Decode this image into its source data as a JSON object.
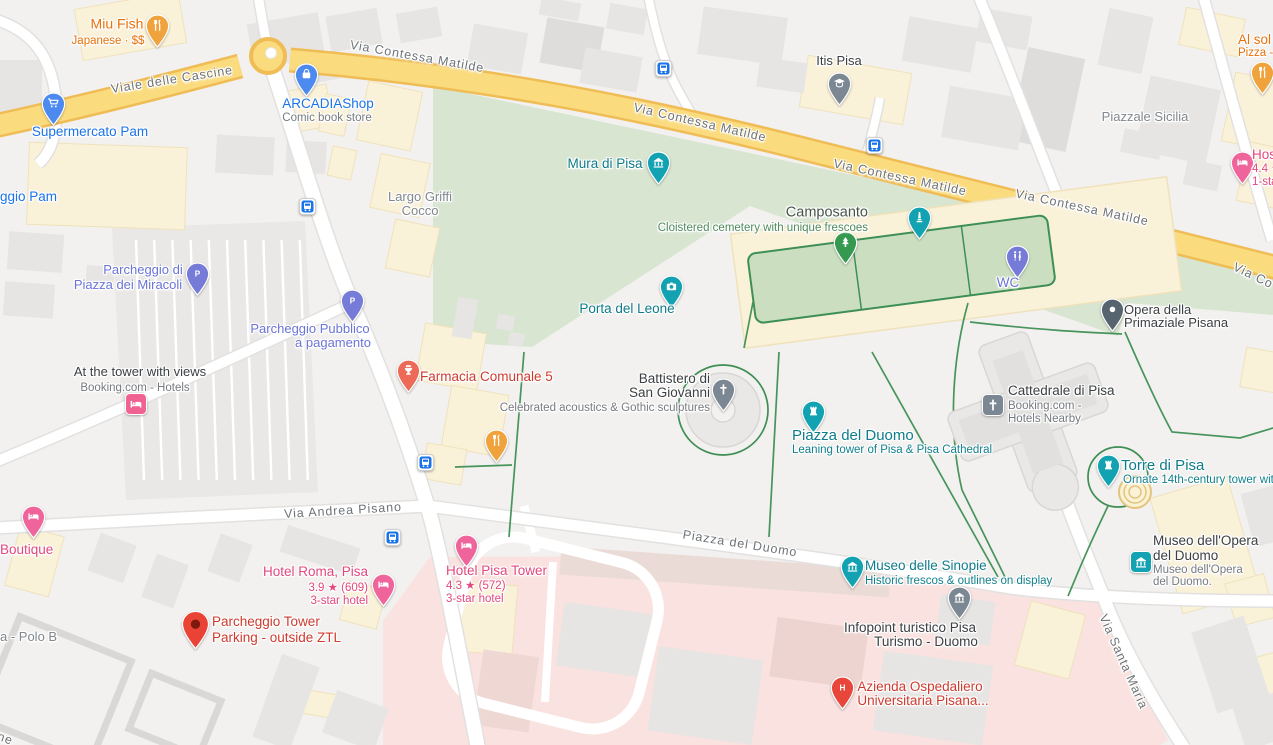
{
  "palette": {
    "land": "#F2F1EF",
    "building": "#E6E5E3",
    "building_dark": "#DEDDDB",
    "building_stroke": "#D9D8D6",
    "commercial": "#FAF1D9",
    "commercial_border": "#EFE2BB",
    "park": "#D8E5D1",
    "courtyard": "#CBDFC0",
    "courtyard_border": "#3D8F55",
    "hospital_area": "#F9E2DF",
    "road_white": "#FFFFFF",
    "road_casing": "#E2E1DF",
    "road_major_fill": "#FADB7E",
    "road_major_casing": "#EFBC55",
    "path_green": "#3E8E54",
    "bus_blue": "#1A73E8",
    "street_label": "#6E7377",
    "area_label": "#82878C"
  },
  "road_labels": [
    {
      "text": "Viale delle Cascine",
      "x": 172,
      "y": 80,
      "rot": -9
    },
    {
      "text": "Via Contessa Matilde",
      "x": 417,
      "y": 57,
      "rot": 10
    },
    {
      "text": "Via Contessa Matilde",
      "x": 700,
      "y": 123,
      "rot": 13
    },
    {
      "text": "Via Contessa Matilde",
      "x": 900,
      "y": 178,
      "rot": 12
    },
    {
      "text": "Via Contessa Matilde",
      "x": 1082,
      "y": 208,
      "rot": 12
    },
    {
      "text": "Via Co",
      "x": 1253,
      "y": 276,
      "rot": 26
    },
    {
      "text": "Via Andrea Pisano",
      "x": 343,
      "y": 511,
      "rot": -3.5
    },
    {
      "text": "Piazza del Duomo",
      "x": 740,
      "y": 544,
      "rot": 9
    },
    {
      "text": "Via Santa Maria",
      "x": 1123,
      "y": 662,
      "rot": 66
    },
    {
      "text": "ne",
      "x": 5,
      "y": 739,
      "rot": 20
    }
  ],
  "area_labels": [
    {
      "text": "Largo Griffi",
      "x": 420,
      "y": 197,
      "align": "center"
    },
    {
      "text": "Cocco",
      "x": 420,
      "y": 211,
      "align": "center"
    },
    {
      "text": "Piazzale Sicilia",
      "x": 1145,
      "y": 117,
      "align": "center"
    },
    {
      "text": "a - Polo B",
      "x": 0,
      "y": 637,
      "align": "left"
    }
  ],
  "bus_stops": [
    {
      "x": 663,
      "y": 68
    },
    {
      "x": 874,
      "y": 145
    },
    {
      "x": 307,
      "y": 206
    },
    {
      "x": 425,
      "y": 462
    },
    {
      "x": 392,
      "y": 537
    }
  ],
  "pois": [
    {
      "name": "miu-fish",
      "pin": {
        "x": 157,
        "y": 26,
        "shape": "pin",
        "color": "#F0A33C",
        "icon": "restaurant"
      },
      "lines": [
        {
          "text": "Miu Fish",
          "x": 117,
          "y": 24,
          "size": 14,
          "color": "#E8710A",
          "align": "center",
          "w": 500
        },
        {
          "text": "Japanese · $$",
          "x": 108,
          "y": 41,
          "size": 11.5,
          "color": "#E8710A",
          "align": "center",
          "w": 400
        }
      ]
    },
    {
      "name": "supermercato-pam",
      "pin": {
        "x": 53,
        "y": 104,
        "shape": "pin",
        "color": "#4D8AF0",
        "icon": "cart"
      },
      "lines": [
        {
          "text": "Supermercato Pam",
          "x": 90,
          "y": 132,
          "size": 13.5,
          "color": "#1A73E8",
          "align": "center",
          "w": 500
        }
      ]
    },
    {
      "name": "parcheggio-pam",
      "lines": [
        {
          "text": "ggio Pam",
          "x": 0,
          "y": 197,
          "size": 13.5,
          "color": "#1A73E8",
          "align": "left",
          "w": 500
        }
      ]
    },
    {
      "name": "arcadia-shop",
      "pin": {
        "x": 306,
        "y": 75,
        "shape": "pin",
        "color": "#4D8AF0",
        "icon": "bag"
      },
      "lines": [
        {
          "text": "ARCADIAShop",
          "x": 328,
          "y": 104,
          "size": 13.5,
          "color": "#1A73E8",
          "align": "center",
          "w": 500
        },
        {
          "text": "Comic book store",
          "x": 327,
          "y": 118,
          "size": 11.5,
          "color": "#767B80",
          "align": "center",
          "w": 400
        }
      ]
    },
    {
      "name": "itis-pisa",
      "pin": {
        "x": 839,
        "y": 84,
        "shape": "pin",
        "color": "#7B8893",
        "icon": "school"
      },
      "lines": [
        {
          "text": "Itis Pisa",
          "x": 839,
          "y": 61,
          "size": 13,
          "color": "#3C4043",
          "align": "center",
          "w": 500
        }
      ]
    },
    {
      "name": "mura-di-pisa",
      "pin": {
        "x": 658,
        "y": 163,
        "shape": "pin",
        "color": "#12A2B2",
        "icon": "museum"
      },
      "lines": [
        {
          "text": "Mura di Pisa",
          "x": 605,
          "y": 164,
          "size": 13.5,
          "color": "#0E7C8A",
          "align": "center",
          "w": 500
        }
      ]
    },
    {
      "name": "camposanto",
      "pin": {
        "x": 845,
        "y": 243,
        "shape": "pin",
        "color": "#359A4F",
        "icon": "tree"
      },
      "lines": [
        {
          "text": "Camposanto",
          "x": 868,
          "y": 213,
          "size": 14.5,
          "color": "#48534A",
          "align": "right",
          "w": 500
        },
        {
          "text": "Cloistered cemetery with unique frescoes",
          "x": 868,
          "y": 228,
          "size": 11.5,
          "color": "#4F8A5C",
          "align": "right",
          "w": 400
        }
      ]
    },
    {
      "name": "camposanto-monument",
      "pin": {
        "x": 919,
        "y": 218,
        "shape": "pin",
        "color": "#12A2B2",
        "icon": "monument"
      },
      "lines": []
    },
    {
      "name": "wc",
      "pin": {
        "x": 1017,
        "y": 257,
        "shape": "pin",
        "color": "#767BD8",
        "icon": "toilets"
      },
      "lines": [
        {
          "text": "WC",
          "x": 1008,
          "y": 283,
          "size": 13.5,
          "color": "#6B74D8",
          "align": "center",
          "w": 500
        }
      ]
    },
    {
      "name": "porta-del-leone",
      "pin": {
        "x": 671,
        "y": 287,
        "shape": "pin",
        "color": "#12A2B2",
        "icon": "camera"
      },
      "lines": [
        {
          "text": "Porta del Leone",
          "x": 627,
          "y": 309,
          "size": 13.5,
          "color": "#0E7C8A",
          "align": "center",
          "w": 500
        }
      ]
    },
    {
      "name": "opera-della-primaziale-pisana",
      "pin": {
        "x": 1112,
        "y": 310,
        "shape": "pin",
        "color": "#55646F",
        "icon": "dot"
      },
      "lines": [
        {
          "text": "Opera della",
          "x": 1124,
          "y": 310,
          "size": 13,
          "color": "#3C4043",
          "align": "left",
          "w": 500
        },
        {
          "text": "Primaziale Pisana",
          "x": 1124,
          "y": 323,
          "size": 13,
          "color": "#3C4043",
          "align": "left",
          "w": 500
        }
      ]
    },
    {
      "name": "parcheggio-piazza-dei-miracoli",
      "pin": {
        "x": 197,
        "y": 274,
        "shape": "pin",
        "color": "#767BD8",
        "icon": "P"
      },
      "lines": [
        {
          "text": "Parcheggio di",
          "x": 143,
          "y": 270,
          "size": 13,
          "color": "#6B74D8",
          "align": "center",
          "w": 500
        },
        {
          "text": "Piazza dei Miracoli",
          "x": 128,
          "y": 285,
          "size": 13,
          "color": "#6B74D8",
          "align": "center",
          "w": 500
        }
      ]
    },
    {
      "name": "parcheggio-pubblico",
      "pin": {
        "x": 352,
        "y": 301,
        "shape": "pin",
        "color": "#767BD8",
        "icon": "P"
      },
      "lines": [
        {
          "text": "Parcheggio Pubblico",
          "x": 310,
          "y": 329,
          "size": 13,
          "color": "#6B74D8",
          "align": "center",
          "w": 500
        },
        {
          "text": "a pagamento",
          "x": 333,
          "y": 343,
          "size": 13,
          "color": "#6B74D8",
          "align": "center",
          "w": 500
        }
      ]
    },
    {
      "name": "at-the-tower-with-views",
      "pin": {
        "x": 136,
        "y": 404,
        "shape": "chip",
        "color": "#F06292",
        "icon": "bed"
      },
      "lines": [
        {
          "text": "At the tower with views",
          "x": 140,
          "y": 372,
          "size": 13,
          "color": "#3C4043",
          "align": "center",
          "w": 500
        },
        {
          "text": "Booking.com - Hotels",
          "x": 135,
          "y": 388,
          "size": 11.5,
          "color": "#767B80",
          "align": "center",
          "w": 400
        }
      ]
    },
    {
      "name": "farmacia-comunale-5",
      "pin": {
        "x": 408,
        "y": 371,
        "shape": "pin",
        "color": "#EC6A57",
        "icon": "pharmacy"
      },
      "lines": [
        {
          "text": "Farmacia Comunale 5",
          "x": 420,
          "y": 377,
          "size": 13.5,
          "color": "#CE3A2E",
          "align": "left",
          "w": 500
        }
      ]
    },
    {
      "name": "battistero-di-san-giovanni",
      "pin": {
        "x": 723,
        "y": 390,
        "shape": "pin",
        "color": "#7B8893",
        "icon": "cross"
      },
      "lines": [
        {
          "text": "Battistero di",
          "x": 710,
          "y": 379,
          "size": 13.5,
          "color": "#3C4043",
          "align": "right",
          "w": 500
        },
        {
          "text": "San Giovanni",
          "x": 710,
          "y": 393,
          "size": 13.5,
          "color": "#3C4043",
          "align": "right",
          "w": 500
        },
        {
          "text": "Celebrated acoustics & Gothic sculptures",
          "x": 710,
          "y": 408,
          "size": 11.5,
          "color": "#767B80",
          "align": "right",
          "w": 400
        }
      ]
    },
    {
      "name": "piazza-del-duomo",
      "pin": {
        "x": 813,
        "y": 412,
        "shape": "pin",
        "color": "#12A2B2",
        "icon": "fort"
      },
      "lines": [
        {
          "text": "Piazza del Duomo",
          "x": 792,
          "y": 436,
          "size": 15,
          "color": "#0E7C8A",
          "align": "left",
          "w": 500
        },
        {
          "text": "Leaning tower of Pisa & Pisa Cathedral",
          "x": 792,
          "y": 450,
          "size": 11.5,
          "color": "#12818E",
          "align": "left",
          "w": 400
        }
      ]
    },
    {
      "name": "cattedrale-di-pisa",
      "pin": {
        "x": 993,
        "y": 405,
        "shape": "chip",
        "color": "#7B8893",
        "icon": "cross"
      },
      "lines": [
        {
          "text": "Cattedrale di Pisa",
          "x": 1008,
          "y": 391,
          "size": 13.5,
          "color": "#3C4043",
          "align": "left",
          "w": 500
        },
        {
          "text": "Booking.com -",
          "x": 1008,
          "y": 406,
          "size": 11.5,
          "color": "#767B80",
          "align": "left",
          "w": 400
        },
        {
          "text": "Hotels Nearby",
          "x": 1008,
          "y": 419,
          "size": 11.5,
          "color": "#767B80",
          "align": "left",
          "w": 400
        }
      ]
    },
    {
      "name": "restaurant-via-roma",
      "pin": {
        "x": 496,
        "y": 441,
        "shape": "pin",
        "color": "#F0A33C",
        "icon": "restaurant"
      },
      "lines": []
    },
    {
      "name": "torre-di-pisa",
      "pin": {
        "x": 1108,
        "y": 466,
        "shape": "pin",
        "color": "#12A2B2",
        "icon": "fort"
      },
      "lines": [
        {
          "text": "Torre di Pisa",
          "x": 1121,
          "y": 466,
          "size": 15,
          "color": "#0E7C8A",
          "align": "left",
          "w": 500
        },
        {
          "text": "Ornate 14th-century tower with",
          "x": 1123,
          "y": 480,
          "size": 11.5,
          "color": "#12818E",
          "align": "left",
          "w": 400
        }
      ]
    },
    {
      "name": "museo-dell-opera-del-duomo",
      "pin": {
        "x": 1141,
        "y": 562,
        "shape": "chip",
        "color": "#12A2B2",
        "icon": "museum"
      },
      "lines": [
        {
          "text": "Museo dell'Opera",
          "x": 1153,
          "y": 541,
          "size": 13.5,
          "color": "#3C4043",
          "align": "left",
          "w": 500
        },
        {
          "text": "del Duomo",
          "x": 1153,
          "y": 556,
          "size": 13.5,
          "color": "#3C4043",
          "align": "left",
          "w": 500
        },
        {
          "text": "Museo dell'Opera",
          "x": 1153,
          "y": 570,
          "size": 11.5,
          "color": "#767B80",
          "align": "left",
          "w": 400
        },
        {
          "text": "del Duomo.",
          "x": 1153,
          "y": 582,
          "size": 11.5,
          "color": "#767B80",
          "align": "left",
          "w": 400
        }
      ]
    },
    {
      "name": "museo-delle-sinopie",
      "pin": {
        "x": 852,
        "y": 567,
        "shape": "pin",
        "color": "#12A2B2",
        "icon": "museum"
      },
      "lines": [
        {
          "text": "Museo delle Sinopie",
          "x": 865,
          "y": 566,
          "size": 13.5,
          "color": "#0E7C8A",
          "align": "left",
          "w": 500
        },
        {
          "text": "Historic frescos & outlines on display",
          "x": 865,
          "y": 581,
          "size": 11.5,
          "color": "#12818E",
          "align": "left",
          "w": 400
        }
      ]
    },
    {
      "name": "infopoint-turistico",
      "pin": {
        "x": 959,
        "y": 598,
        "shape": "pin",
        "color": "#7B8893",
        "icon": "museum"
      },
      "lines": [
        {
          "text": "Infopoint turistico Pisa",
          "x": 910,
          "y": 628,
          "size": 13.5,
          "color": "#3C4043",
          "align": "center",
          "w": 500
        },
        {
          "text": "Turismo - Duomo",
          "x": 926,
          "y": 642,
          "size": 13.5,
          "color": "#3C4043",
          "align": "center",
          "w": 500
        }
      ]
    },
    {
      "name": "azienda-ospedaliero",
      "pin": {
        "x": 842,
        "y": 688,
        "shape": "pin",
        "color": "#E8463B",
        "icon": "H"
      },
      "lines": [
        {
          "text": "Azienda Ospedaliero",
          "x": 920,
          "y": 687,
          "size": 13.5,
          "color": "#CE3A2E",
          "align": "center",
          "w": 500
        },
        {
          "text": "Universitaria Pisana...",
          "x": 923,
          "y": 701,
          "size": 13.5,
          "color": "#CE3A2E",
          "align": "center",
          "w": 500
        }
      ]
    },
    {
      "name": "hotel-roma-pisa",
      "pin": {
        "x": 383,
        "y": 585,
        "shape": "pin",
        "color": "#EF659B",
        "icon": "bed"
      },
      "lines": [
        {
          "text": "Hotel Roma, Pisa",
          "x": 368,
          "y": 572,
          "size": 13.5,
          "color": "#E2487F",
          "align": "right",
          "w": 500
        },
        {
          "text": "3.9 ★ (609)",
          "x": 368,
          "y": 588,
          "size": 11.5,
          "color": "#E2487F",
          "align": "right",
          "w": 400
        },
        {
          "text": "3-star hotel",
          "x": 368,
          "y": 601,
          "size": 11.5,
          "color": "#E2487F",
          "align": "right",
          "w": 400
        }
      ]
    },
    {
      "name": "hotel-pisa-tower",
      "pin": {
        "x": 466,
        "y": 546,
        "shape": "pin",
        "color": "#EF659B",
        "icon": "bed"
      },
      "lines": [
        {
          "text": "Hotel Pisa Tower",
          "x": 446,
          "y": 571,
          "size": 13.5,
          "color": "#E2487F",
          "align": "left",
          "w": 500
        },
        {
          "text": "4.3 ★ (572)",
          "x": 446,
          "y": 586,
          "size": 11.5,
          "color": "#E2487F",
          "align": "left",
          "w": 400
        },
        {
          "text": "3-star hotel",
          "x": 446,
          "y": 599,
          "size": 11.5,
          "color": "#E2487F",
          "align": "left",
          "w": 400
        }
      ]
    },
    {
      "name": "parcheggio-tower-parking",
      "pin": {
        "x": 195,
        "y": 624,
        "shape": "marker",
        "color": "#EA4335"
      },
      "lines": [
        {
          "text": "Parcheggio Tower",
          "x": 212,
          "y": 622,
          "size": 13.5,
          "color": "#CE3A2E",
          "align": "left",
          "w": 500
        },
        {
          "text": "Parking - outside ZTL",
          "x": 212,
          "y": 638,
          "size": 13.5,
          "color": "#CE3A2E",
          "align": "left",
          "w": 500
        }
      ]
    },
    {
      "name": "boutique-hotel",
      "pin": {
        "x": 33,
        "y": 517,
        "shape": "pin",
        "color": "#EF659B",
        "icon": "bed"
      },
      "lines": [
        {
          "text": "Boutique",
          "x": 0,
          "y": 550,
          "size": 13.5,
          "color": "#E2487F",
          "align": "left",
          "w": 500
        }
      ]
    },
    {
      "name": "hostel-top-right",
      "pin": {
        "x": 1242,
        "y": 163,
        "shape": "pin",
        "color": "#EF659B",
        "icon": "bed"
      },
      "lines": [
        {
          "text": "Hos",
          "x": 1252,
          "y": 155,
          "size": 13.5,
          "color": "#E2487F",
          "align": "left",
          "w": 500
        },
        {
          "text": "4.4 ★",
          "x": 1252,
          "y": 169,
          "size": 11.5,
          "color": "#E2487F",
          "align": "left",
          "w": 400
        },
        {
          "text": "1-sta",
          "x": 1252,
          "y": 182,
          "size": 11.5,
          "color": "#E2487F",
          "align": "left",
          "w": 400
        }
      ]
    },
    {
      "name": "al-sole-pizza",
      "pin": {
        "x": 1262,
        "y": 73,
        "shape": "pin",
        "color": "#F0A33C",
        "icon": "restaurant"
      },
      "lines": [
        {
          "text": "Al sol",
          "x": 1238,
          "y": 40,
          "size": 13.5,
          "color": "#E8710A",
          "align": "left",
          "w": 500
        },
        {
          "text": "Pizza -",
          "x": 1238,
          "y": 53,
          "size": 11.5,
          "color": "#E8710A",
          "align": "left",
          "w": 400
        }
      ]
    }
  ]
}
